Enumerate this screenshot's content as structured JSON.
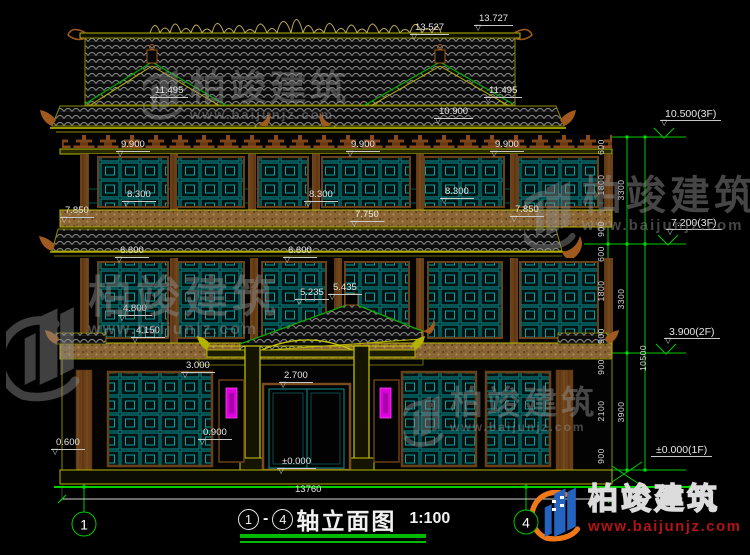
{
  "palette": {
    "background": "#000000",
    "line_yellow": "#b4b400",
    "line_green": "#00c800",
    "lattice_teal": "#00a2a2",
    "wood_brown": "#8a4a1e",
    "accent_magenta": "#dd00dd",
    "dim_text": "#e6e6e6",
    "title_green": "#00bb00",
    "brand_blue": "#2563c0",
    "brand_orange": "#f07818",
    "brand_red": "#b01515"
  },
  "drawing": {
    "elevation_labels": [
      {
        "text": "13.527",
        "x": 410,
        "y": 23
      },
      {
        "text": "13.727",
        "x": 474,
        "y": 14
      },
      {
        "text": "11.495",
        "x": 150,
        "y": 86
      },
      {
        "text": "11.495",
        "x": 484,
        "y": 86
      },
      {
        "text": "10.900",
        "x": 434,
        "y": 107
      },
      {
        "text": "9.900",
        "x": 116,
        "y": 140
      },
      {
        "text": "9.900",
        "x": 346,
        "y": 140
      },
      {
        "text": "9.900",
        "x": 490,
        "y": 140
      },
      {
        "text": "8.300",
        "x": 122,
        "y": 190
      },
      {
        "text": "8.300",
        "x": 304,
        "y": 190
      },
      {
        "text": "8.300",
        "x": 440,
        "y": 187
      },
      {
        "text": "7.850",
        "x": 60,
        "y": 206
      },
      {
        "text": "7.850",
        "x": 510,
        "y": 205
      },
      {
        "text": "7.750",
        "x": 350,
        "y": 210
      },
      {
        "text": "6.600",
        "x": 115,
        "y": 246
      },
      {
        "text": "6.600",
        "x": 283,
        "y": 246
      },
      {
        "text": "5.235",
        "x": 295,
        "y": 288
      },
      {
        "text": "5.435",
        "x": 328,
        "y": 283
      },
      {
        "text": "4.800",
        "x": 118,
        "y": 304
      },
      {
        "text": "4.150",
        "x": 131,
        "y": 326
      },
      {
        "text": "3.000",
        "x": 181,
        "y": 361
      },
      {
        "text": "2.700",
        "x": 279,
        "y": 371
      },
      {
        "text": "0.900",
        "x": 198,
        "y": 428
      },
      {
        "text": "0.600",
        "x": 51,
        "y": 438
      },
      {
        "text": "±0.000",
        "x": 277,
        "y": 457
      }
    ],
    "overall_width": {
      "text": "13760",
      "x": 290,
      "y": 485
    },
    "right_chain": {
      "floor_labels": [
        {
          "text": "10.500(3F)",
          "x": 660,
          "y": 109
        },
        {
          "text": "7.200(3F)",
          "x": 666,
          "y": 218
        },
        {
          "text": "3.900(2F)",
          "x": 664,
          "y": 327
        },
        {
          "text": "±0.000(1F)",
          "x": 651,
          "y": 445,
          "marker": "none"
        }
      ],
      "segment_values": [
        {
          "text": "600",
          "x": 601,
          "y": 147
        },
        {
          "text": "1800",
          "x": 601,
          "y": 185
        },
        {
          "text": "900",
          "x": 601,
          "y": 229
        },
        {
          "text": "600",
          "x": 601,
          "y": 254
        },
        {
          "text": "1800",
          "x": 601,
          "y": 291
        },
        {
          "text": "900",
          "x": 601,
          "y": 336
        },
        {
          "text": "900",
          "x": 601,
          "y": 367
        },
        {
          "text": "2100",
          "x": 601,
          "y": 411
        },
        {
          "text": "900",
          "x": 601,
          "y": 456
        },
        {
          "text": "3300",
          "x": 621,
          "y": 190
        },
        {
          "text": "3300",
          "x": 621,
          "y": 299
        },
        {
          "text": "3900",
          "x": 621,
          "y": 412
        },
        {
          "text": "10500",
          "x": 643,
          "y": 358
        }
      ]
    },
    "axis_bubbles": [
      {
        "label": "1",
        "x": 84,
        "y": 524
      },
      {
        "label": "4",
        "x": 526,
        "y": 522
      }
    ]
  },
  "title_bar": {
    "axis_from": "1",
    "dash": "-",
    "axis_to": "4",
    "name": "轴立面图",
    "scale": "1:100"
  },
  "watermarks": [
    {
      "text": "柏竣建筑",
      "url": "www.baijunjz.com",
      "x": 190,
      "y": 70,
      "size": 36
    },
    {
      "text": "柏竣建筑",
      "url": "www.baijunjz.com",
      "x": 88,
      "y": 276,
      "size": 44
    },
    {
      "text": "柏竣建筑",
      "url": "www.baijunjz.com",
      "x": 582,
      "y": 176,
      "size": 40
    },
    {
      "text": "柏竣建筑",
      "url": "www.baijunjz.com",
      "x": 450,
      "y": 386,
      "size": 33
    }
  ],
  "brand_logo": {
    "name": "柏竣建筑",
    "url": "www.baijunjz.com"
  }
}
